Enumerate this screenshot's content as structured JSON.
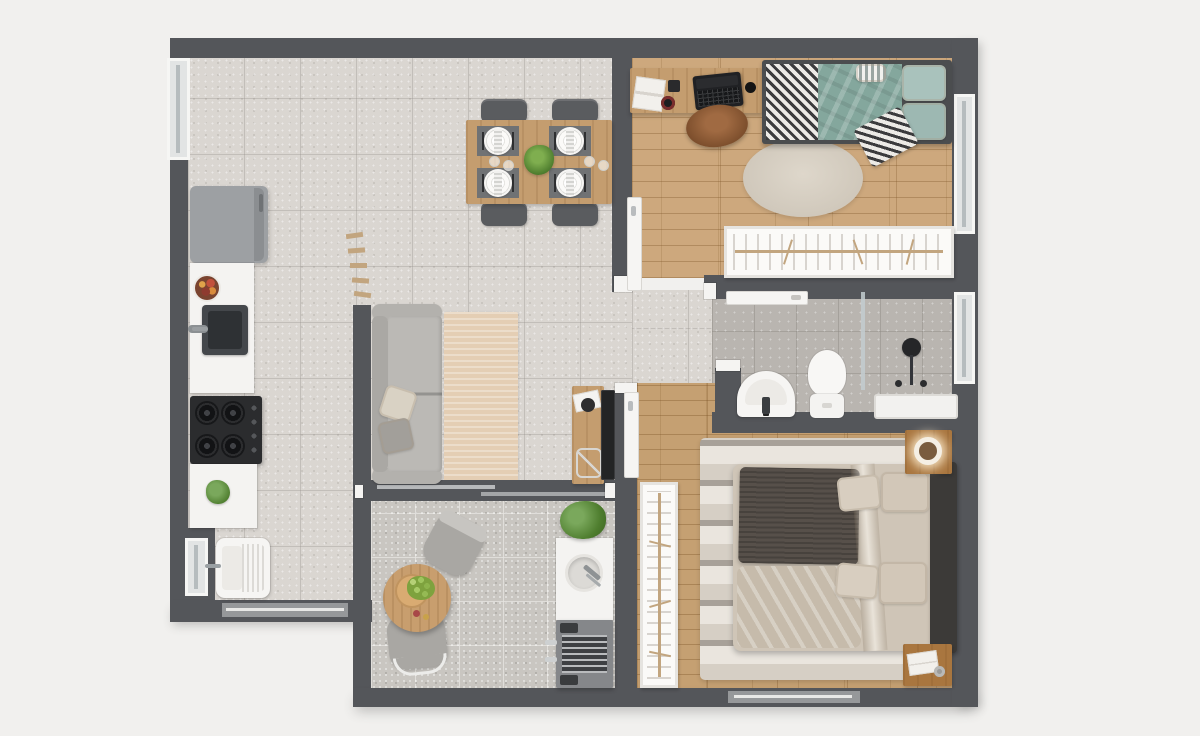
{
  "meta": {
    "kind": "apartment-floor-plan-3d-render",
    "view": "top-down",
    "text_visible": false
  },
  "palette": {
    "bg": "#f1f0ee",
    "wall": "#54565a",
    "counter": "#f4f3f1",
    "fridge": "#9da0a3",
    "wood1": "#cda87d",
    "wood2": "#c5a072",
    "furnwood": "#c49d6f",
    "tileMain": "#dad6d1",
    "tileBath": "#b9b5b0",
    "tileBalc": "#c9c6c1",
    "sofa": "#bbb9b5",
    "teal": "#84a79d",
    "tealLight": "#a9c2bc",
    "rugLiving": "#e4ceb4",
    "rugRound": "#d8d1c5",
    "duvet": "#cfc5b7",
    "throwDark": "#57504a",
    "headboard": "#3c3a38",
    "grill": "#85878a",
    "plant": "#5d8f46"
  },
  "rooms": {
    "kitchen_dining_living": {
      "floor": "light-gray-tile",
      "furniture": [
        "refrigerator",
        "counter-with-fruit-bowl",
        "kitchen-sink",
        "gas-stove-4-burners",
        "counter-with-plant",
        "laundry-tub",
        "dining-table-4-place-settings",
        "4-dining-chairs",
        "center-plant",
        "sofa-2-cushions",
        "2-throw-pillows",
        "living-rug",
        "wall-shelves-5",
        "tv-console",
        "wall-tv"
      ]
    },
    "bedroom_1": {
      "floor": "wood-planks",
      "furniture": [
        "desk",
        "laptop",
        "book-stack",
        "mug",
        "mouse",
        "desk-chair",
        "single-bed-teal",
        "zigzag-blanket",
        "round-rug",
        "wardrobe-with-hangers",
        "open-door"
      ]
    },
    "bathroom": {
      "floor": "gray-tile",
      "furniture": [
        "washbasin",
        "toilet",
        "glass-partition",
        "shower-head",
        "shower-tray",
        "sliding-door"
      ]
    },
    "master_bedroom": {
      "floor": "wood-planks",
      "furniture": [
        "double-bed",
        "dark-knit-throw",
        "4-pillows",
        "headboard",
        "striped-rug",
        "wardrobe-with-hangers",
        "nightstand-with-ring-lamp",
        "nightstand-with-book-and-vase",
        "open-door"
      ]
    },
    "balcony": {
      "floor": "speckled-gray-tile",
      "furniture": [
        "round-bistro-table",
        "serving-board-with-grapes",
        "2-round-chairs",
        "counter-with-round-sink",
        "potted-plant",
        "barbecue-grill"
      ]
    }
  },
  "openings": {
    "windows": [
      "kitchen-left-window",
      "laundry-window",
      "bedroom1-right-window",
      "bathroom-right-window"
    ],
    "sliders": [
      "living-to-balcony-slider",
      "kitchen-bottom-slider",
      "master-bottom-window-slider"
    ],
    "doors": [
      "bedroom1-door",
      "bathroom-door",
      "master-bedroom-door"
    ]
  }
}
